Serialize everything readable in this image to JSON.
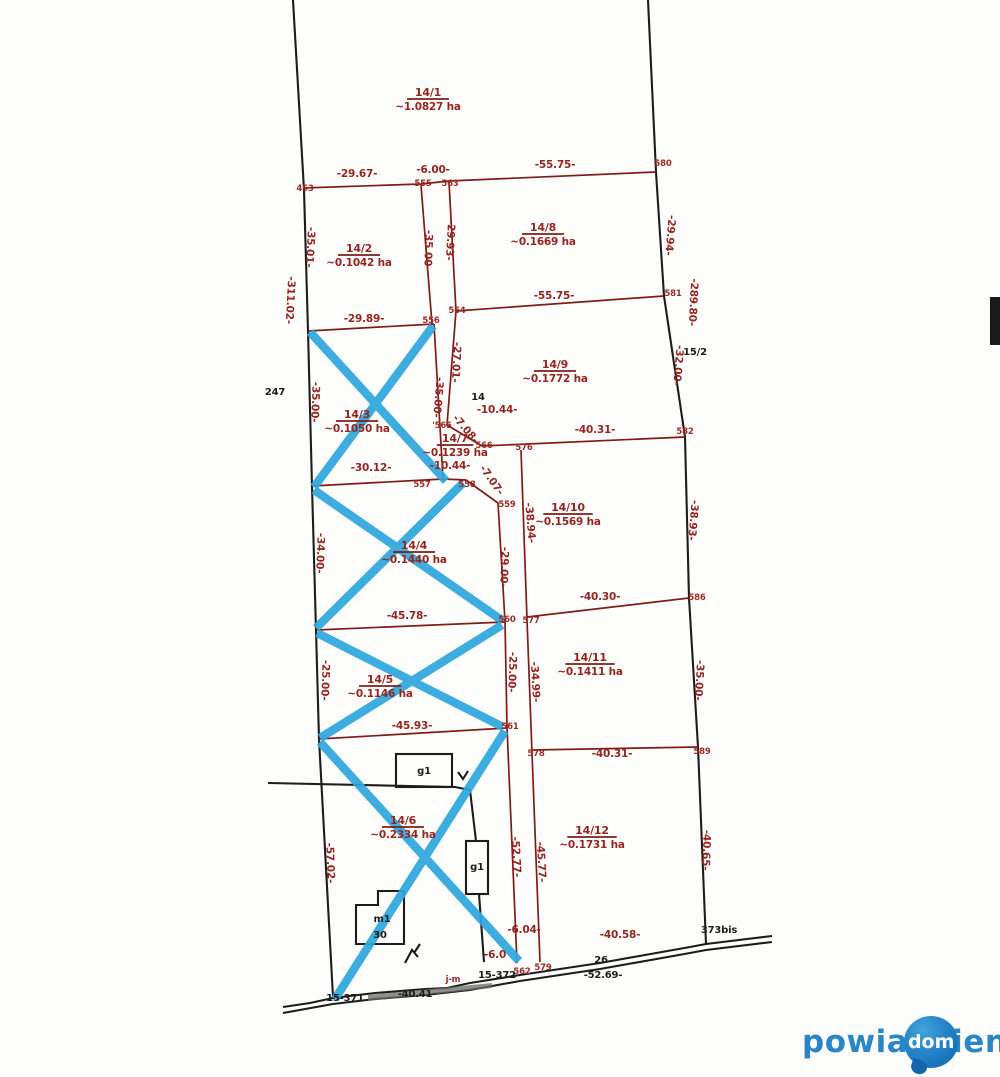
{
  "watermark": {
    "part1": "powia",
    "bubble_text": "dom",
    "part2": "ieni"
  },
  "colors": {
    "survey_red": "#96251f",
    "boundary_black": "#1c1c1c",
    "cross_blue": "#2ea7de",
    "watermark_blue": "#2b86c6",
    "bubble_blue": "#1f7ec4"
  },
  "map": {
    "parcels": [
      {
        "num": "14/1",
        "area": "~1.0827 ha",
        "x": 428,
        "y": 96,
        "crossed": false
      },
      {
        "num": "14/2",
        "area": "~0.1042 ha",
        "x": 359,
        "y": 252,
        "crossed": false
      },
      {
        "num": "14/8",
        "area": "~0.1669 ha",
        "x": 543,
        "y": 231,
        "crossed": false
      },
      {
        "num": "14/3",
        "area": "~0.1050 ha",
        "x": 357,
        "y": 418,
        "crossed": true
      },
      {
        "num": "14/9",
        "area": "~0.1772 ha",
        "x": 555,
        "y": 368,
        "crossed": false
      },
      {
        "num": "14/7",
        "area": "~0.1239 ha",
        "x": 455,
        "y": 442,
        "s": 9,
        "crossed": false
      },
      {
        "num": "14/10",
        "area": "~0.1569 ha",
        "x": 568,
        "y": 511,
        "crossed": false
      },
      {
        "num": "14/4",
        "area": "~0.1440 ha",
        "x": 414,
        "y": 549,
        "crossed": true
      },
      {
        "num": "14/11",
        "area": "~0.1411 ha",
        "x": 590,
        "y": 661,
        "crossed": false
      },
      {
        "num": "14/5",
        "area": "~0.1146 ha",
        "x": 380,
        "y": 683,
        "crossed": true
      },
      {
        "num": "14/12",
        "area": "~0.1731 ha",
        "x": 592,
        "y": 834,
        "crossed": false
      },
      {
        "num": "14/6",
        "area": "~0.2334 ha",
        "x": 403,
        "y": 824,
        "crossed": true
      }
    ],
    "labels": [
      {
        "t": "-29.67-",
        "x": 357,
        "y": 177,
        "c": "red"
      },
      {
        "t": "-6.00-",
        "x": 433,
        "y": 173,
        "c": "red"
      },
      {
        "t": "-55.75-",
        "x": 555,
        "y": 168,
        "c": "red"
      },
      {
        "t": "-55.75-",
        "x": 554,
        "y": 299,
        "c": "red"
      },
      {
        "t": "-29.89-",
        "x": 364,
        "y": 322,
        "c": "red"
      },
      {
        "t": "-30.12-",
        "x": 371,
        "y": 471,
        "c": "red"
      },
      {
        "t": "-10.44-",
        "x": 497,
        "y": 413,
        "c": "red"
      },
      {
        "t": "-10.44-",
        "x": 450,
        "y": 469,
        "c": "red"
      },
      {
        "t": "-40.31-",
        "x": 595,
        "y": 433,
        "c": "red"
      },
      {
        "t": "-40.30-",
        "x": 600,
        "y": 600,
        "c": "red"
      },
      {
        "t": "-45.78-",
        "x": 407,
        "y": 619,
        "c": "red"
      },
      {
        "t": "-45.93-",
        "x": 412,
        "y": 729,
        "c": "red"
      },
      {
        "t": "-40.31-",
        "x": 612,
        "y": 757,
        "c": "red"
      },
      {
        "t": "-6.04-",
        "x": 524,
        "y": 933,
        "c": "red",
        "s": 9
      },
      {
        "t": "-6.0",
        "x": 495,
        "y": 958,
        "c": "red",
        "s": 8
      },
      {
        "t": "-40.58-",
        "x": 620,
        "y": 938,
        "c": "red"
      },
      {
        "t": "-35.01-",
        "x": 307,
        "y": 247,
        "c": "red",
        "r": 93
      },
      {
        "t": "-311.02-",
        "x": 287,
        "y": 300,
        "c": "red",
        "r": 93
      },
      {
        "t": "-35.00-",
        "x": 425,
        "y": 250,
        "c": "red",
        "r": 92
      },
      {
        "t": "-29.93-",
        "x": 447,
        "y": 240,
        "c": "red",
        "r": 93
      },
      {
        "t": "-29.94-",
        "x": 667,
        "y": 235,
        "c": "red",
        "r": 95
      },
      {
        "t": "-289.80-",
        "x": 690,
        "y": 302,
        "c": "red",
        "r": 93
      },
      {
        "t": "-32.00-",
        "x": 675,
        "y": 365,
        "c": "red",
        "r": 95
      },
      {
        "t": "-35.00-",
        "x": 312,
        "y": 402,
        "c": "red",
        "r": 92
      },
      {
        "t": "-35.00-",
        "x": 435,
        "y": 397,
        "c": "red",
        "r": 95
      },
      {
        "t": "-27.01-",
        "x": 453,
        "y": 362,
        "c": "red",
        "r": 93
      },
      {
        "t": "-7.08-",
        "x": 463,
        "y": 431,
        "c": "red",
        "r": 50,
        "s": 9.5
      },
      {
        "t": "-7.07-",
        "x": 489,
        "y": 482,
        "c": "red",
        "r": 55,
        "s": 9.5
      },
      {
        "t": "-38.94-",
        "x": 527,
        "y": 523,
        "c": "red",
        "r": 85
      },
      {
        "t": "-38.93-",
        "x": 690,
        "y": 520,
        "c": "red",
        "r": 95
      },
      {
        "t": "-34.00-",
        "x": 317,
        "y": 553,
        "c": "red",
        "r": 92
      },
      {
        "t": "-29.00-",
        "x": 501,
        "y": 567,
        "c": "red",
        "r": 92
      },
      {
        "t": "-25.00-",
        "x": 322,
        "y": 680,
        "c": "red",
        "r": 92
      },
      {
        "t": "-25.00-",
        "x": 509,
        "y": 672,
        "c": "red",
        "r": 92
      },
      {
        "t": "-34.99-",
        "x": 532,
        "y": 682,
        "c": "red",
        "r": 87
      },
      {
        "t": "-35.00-",
        "x": 696,
        "y": 680,
        "c": "red",
        "r": 93
      },
      {
        "t": "-57.02-",
        "x": 327,
        "y": 863,
        "c": "red",
        "r": 88
      },
      {
        "t": "-52.77-",
        "x": 513,
        "y": 857,
        "c": "red",
        "r": 87
      },
      {
        "t": "-45.77-",
        "x": 538,
        "y": 862,
        "c": "red",
        "r": 87
      },
      {
        "t": "-40.65-",
        "x": 703,
        "y": 850,
        "c": "red",
        "r": 92
      },
      {
        "t": "453",
        "x": 305,
        "y": 191,
        "c": "redpt"
      },
      {
        "t": "555",
        "x": 423,
        "y": 186,
        "c": "redpt"
      },
      {
        "t": "563",
        "x": 450,
        "y": 186,
        "c": "redpt"
      },
      {
        "t": "580",
        "x": 663,
        "y": 166,
        "c": "redpt"
      },
      {
        "t": "556",
        "x": 431,
        "y": 323,
        "c": "redpt"
      },
      {
        "t": "564",
        "x": 457,
        "y": 313,
        "c": "redpt"
      },
      {
        "t": "581",
        "x": 673,
        "y": 296,
        "c": "redpt"
      },
      {
        "t": "'565",
        "x": 442,
        "y": 428,
        "c": "redpt"
      },
      {
        "t": "566",
        "x": 484,
        "y": 448,
        "c": "redpt"
      },
      {
        "t": "576",
        "x": 524,
        "y": 450,
        "c": "redpt"
      },
      {
        "t": "582",
        "x": 685,
        "y": 434,
        "c": "redpt"
      },
      {
        "t": "557",
        "x": 422,
        "y": 487,
        "c": "redpt"
      },
      {
        "t": "558",
        "x": 467,
        "y": 487,
        "c": "redpt"
      },
      {
        "t": "559",
        "x": 507,
        "y": 507,
        "c": "redpt"
      },
      {
        "t": "560",
        "x": 507,
        "y": 622,
        "c": "redpt"
      },
      {
        "t": "577",
        "x": 531,
        "y": 623,
        "c": "redpt"
      },
      {
        "t": "586",
        "x": 697,
        "y": 600,
        "c": "redpt"
      },
      {
        "t": "561",
        "x": 510,
        "y": 729,
        "c": "redpt"
      },
      {
        "t": "578",
        "x": 536,
        "y": 756,
        "c": "redpt"
      },
      {
        "t": "589",
        "x": 702,
        "y": 754,
        "c": "redpt"
      },
      {
        "t": "562",
        "x": 522,
        "y": 974,
        "c": "redpt"
      },
      {
        "t": "579",
        "x": 543,
        "y": 970,
        "c": "redpt"
      },
      {
        "t": "j-m",
        "x": 453,
        "y": 982,
        "c": "redpt",
        "s": 7
      },
      {
        "t": "247",
        "x": 275,
        "y": 395,
        "c": "black",
        "s": 11
      },
      {
        "t": "14",
        "x": 478,
        "y": 400,
        "c": "black",
        "s": 10.5
      },
      {
        "t": "15/2",
        "x": 695,
        "y": 355,
        "c": "black",
        "s": 11
      },
      {
        "t": "373bis",
        "x": 719,
        "y": 933,
        "c": "black",
        "s": 8
      },
      {
        "t": "15-371",
        "x": 345,
        "y": 1001,
        "c": "black"
      },
      {
        "t": "-40.41-",
        "x": 417,
        "y": 997,
        "c": "black",
        "s": 11
      },
      {
        "t": "15-372",
        "x": 497,
        "y": 978,
        "c": "black"
      },
      {
        "t": "26",
        "x": 601,
        "y": 963,
        "c": "black"
      },
      {
        "t": "-52.69-",
        "x": 603,
        "y": 978,
        "c": "black",
        "s": 11
      },
      {
        "t": "g1",
        "x": 424,
        "y": 774,
        "c": "black",
        "s": 10
      },
      {
        "t": "g1",
        "x": 477,
        "y": 870,
        "c": "black",
        "s": 9
      },
      {
        "t": "m1",
        "x": 382,
        "y": 922,
        "c": "black",
        "s": 9
      },
      {
        "t": "30",
        "x": 380,
        "y": 938,
        "c": "black",
        "s": 9
      }
    ]
  }
}
